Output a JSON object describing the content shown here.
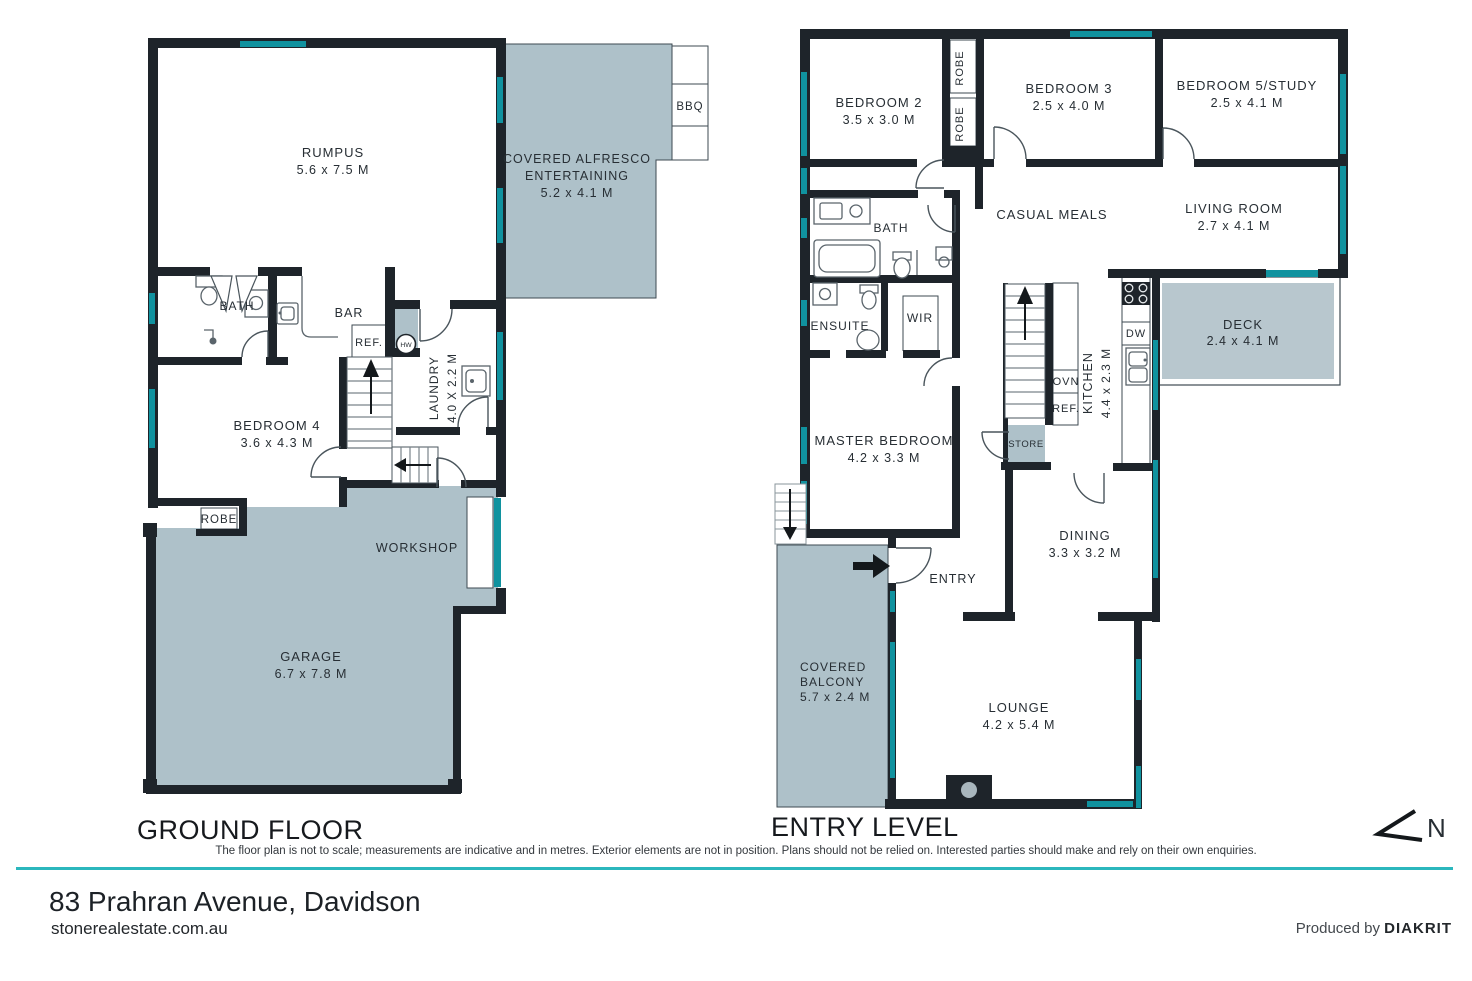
{
  "colors": {
    "wall": "#1e242a",
    "window_teal": "#10929f",
    "outdoor_grey": "#aec1c9",
    "deck_grey": "#b8c7ce",
    "accent_rule_teal": "#2bb7bd",
    "label_text": "#272e34"
  },
  "ground": {
    "title": "GROUND FLOOR",
    "rumpus_name": "RUMPUS",
    "rumpus_dims": "5.6 x 7.5 M",
    "alfresco_line1": "COVERED ALFRESCO",
    "alfresco_line2": "ENTERTAINING",
    "alfresco_dims": "5.2 x 4.1 M",
    "bbq": "BBQ",
    "bath": "BATH",
    "bar": "BAR",
    "ref": "REF.",
    "hw": "HW",
    "laundry_name": "LAUNDRY",
    "laundry_dims": "4.0 X 2.2 M",
    "bedroom4_name": "BEDROOM 4",
    "bedroom4_dims": "3.6 x 4.3 M",
    "robe": "ROBE",
    "workshop": "WORKSHOP",
    "garage_name": "GARAGE",
    "garage_dims": "6.7 x 7.8 M"
  },
  "entry": {
    "title": "ENTRY LEVEL",
    "bedroom2_name": "BEDROOM 2",
    "bedroom2_dims": "3.5 x 3.0 M",
    "robe_a": "ROBE",
    "robe_b": "ROBE",
    "bedroom3_name": "BEDROOM 3",
    "bedroom3_dims": "2.5 x 4.0 M",
    "bedroom5_name": "BEDROOM 5/STUDY",
    "bedroom5_dims": "2.5 x 4.1 M",
    "bath": "BATH",
    "casual_meals": "CASUAL MEALS",
    "living_name": "LIVING ROOM",
    "living_dims": "2.7 x 4.1 M",
    "ensuite": "ENSUITE",
    "wir": "WIR",
    "kitchen_name": "KITCHEN",
    "kitchen_dims": "4.4 x 2.3 M",
    "dw": "DW",
    "ovn": "OVN",
    "ref": "REF.",
    "deck_name": "DECK",
    "deck_dims": "2.4 x 4.1 M",
    "store": "STORE",
    "master_name": "MASTER BEDROOM",
    "master_dims": "4.2 x 3.3 M",
    "dining_name": "DINING",
    "dining_dims": "3.3 x 3.2 M",
    "entry_label": "ENTRY",
    "balcony_line1": "COVERED",
    "balcony_line2": "BALCONY",
    "balcony_dims": "5.7 x 2.4 M",
    "lounge_name": "LOUNGE",
    "lounge_dims": "4.2 x 5.4 M"
  },
  "footer": {
    "disclaimer": "The floor plan is not to scale; measurements are indicative and in metres. Exterior elements are not in position. Plans should not be relied on. Interested parties should make and rely on their own enquiries.",
    "address": "83 Prahran Avenue, Davidson",
    "website": "stonerealestate.com.au",
    "produced_prefix": "Produced by",
    "produced_brand": "DIAKRIT",
    "north": "N"
  }
}
